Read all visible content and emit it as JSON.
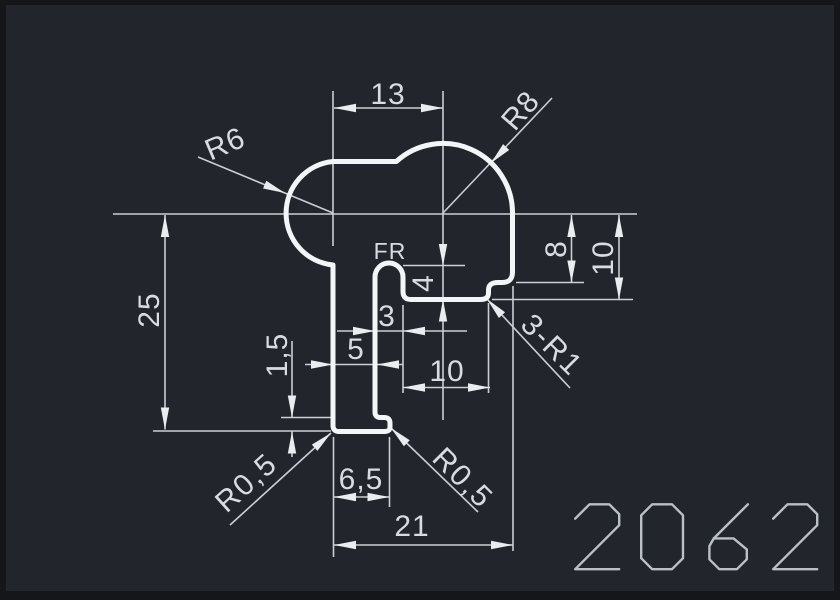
{
  "drawing": {
    "part_number": "2062",
    "surface_label": "FR",
    "dimensions": {
      "top_width": "13",
      "top_right_radius": "R8",
      "top_left_radius": "R6",
      "step_height_8": "8",
      "step_height_10": "10",
      "total_height": "25",
      "slot_depth": "4",
      "slot_width": "3",
      "stem_width": "5",
      "notch_width": "10",
      "step_fillets": "3-R1",
      "foot_height": "1,5",
      "foot_fillet_left": "R0,5",
      "foot_fillet_right": "R0,5",
      "foot_width": "6,5",
      "bottom_width": "21"
    },
    "colors": {
      "frame": "#14161a",
      "canvas": "#22262c",
      "thin_lines": "#c9cfd4",
      "profile_line": "#f3f6f8",
      "dimension_text": "#d7dce0",
      "arrowheads": "#e9edf0",
      "part_number_text": "#b9c0c6"
    }
  }
}
